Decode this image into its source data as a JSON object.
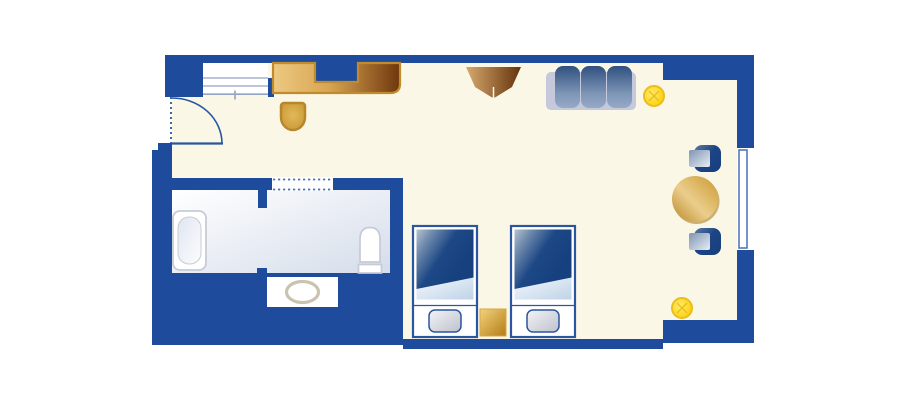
{
  "plan": {
    "type": "hotel-guest-room-floor-plan",
    "rooms": [
      "entry",
      "bathroom",
      "bedroom-living-area"
    ],
    "furniture": [
      "entry-door",
      "wardrobe-closet",
      "desk",
      "desk-chair",
      "tv-stand",
      "sofa",
      "floor-lamp-top",
      "floor-lamp-bottom",
      "round-table",
      "table-chair-top",
      "table-chair-bottom",
      "window",
      "twin-bed-left",
      "twin-bed-right",
      "nightstand",
      "bathtub",
      "toilet",
      "sink-vanity"
    ]
  },
  "colors": {
    "wall": "#1E4B9B",
    "floor": "#FBF7E6",
    "outside": "#FFFFFF",
    "white": "#FFFFFF",
    "line_blue": "#2A55A0",
    "window_frame": "#4A6FB5",
    "shelf_line": "#93A4C0",
    "bath_floor_a": "#FFFFFF",
    "bath_floor_b": "#D5DDEA",
    "fixture_stroke": "#C6CBD6",
    "tub_inner_a": "#DFE5F0",
    "tub_inner_b": "#FDFDFE",
    "basin_stroke": "#C9C3AF",
    "desk_a": "#EDC982",
    "desk_b": "#D8A452",
    "desk_c": "#6F370C",
    "desk_edge": "#C08B2C",
    "dchair_a": "#E2B957",
    "dchair_b": "#C59232",
    "dchair_edge": "#B8872B",
    "tv_a": "#D7A96E",
    "tv_b": "#64330B",
    "sofa_frame": "#C5C9DB",
    "cushion_a": "#30507F",
    "cushion_b": "#7D95B6",
    "cushion_c": "#97AAC6",
    "lamp_a": "#FFEC6E",
    "lamp_b": "#FFD723",
    "lamp_c": "#F7C70A",
    "lamp_edge": "#E9BD1C",
    "table_a": "#B9862B",
    "table_b": "#EBCE8C",
    "table_c": "#C9992F",
    "table_shadow": "#A57414",
    "tchair_a": "#5F7BA2",
    "tchair_b": "#1D4585",
    "tchair_c": "#173E7C",
    "seat_a": "#7E94B4",
    "seat_b": "#E8EDF4",
    "duvet_a": "#B6C2D0",
    "duvet_b": "#6F8AAC",
    "duvet_c": "#1D4886",
    "duvet_d": "#16407E",
    "sheet_a": "#F4F8FC",
    "sheet_b": "#BFD3E8",
    "pillow_a": "#F4F4F7",
    "pillow_b": "#BDC1CB",
    "stand_a": "#F2D37D",
    "stand_b": "#B47C16",
    "stand_edge": "#D8A640"
  }
}
